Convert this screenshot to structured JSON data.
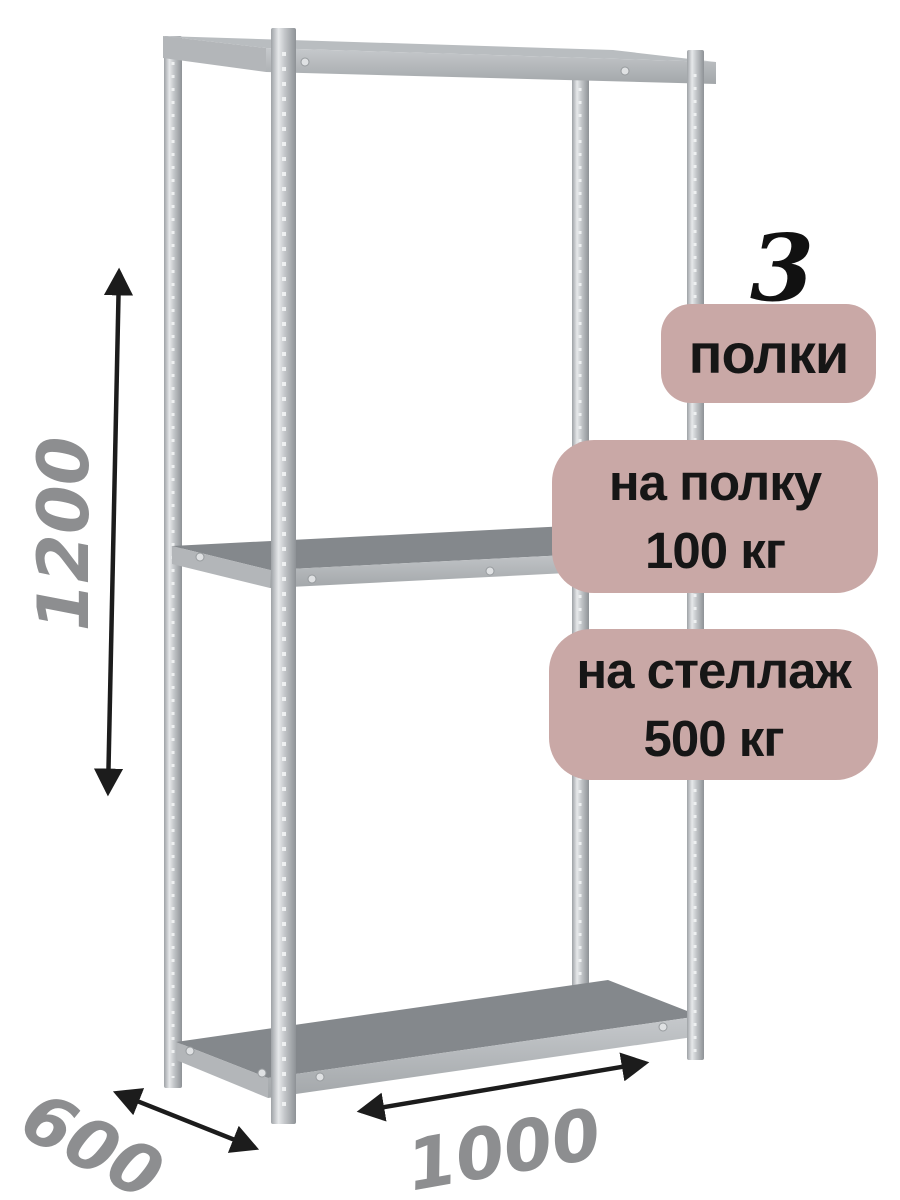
{
  "badges": {
    "shelf_count": {
      "number": "3",
      "label": "полки"
    },
    "shelf_load": {
      "line1": "на полку",
      "line2": "100 кг"
    },
    "rack_load": {
      "line1": "на стеллаж",
      "line2": "500 кг"
    }
  },
  "dimensions": {
    "height": "1200",
    "depth": "600",
    "width": "1000"
  },
  "colors": {
    "background": "#ffffff",
    "badge_bg": "#c9a8a6",
    "badge_text": "#161616",
    "count_text": "#111111",
    "dimension_text": "#8d8e90",
    "arrow": "#1c1c1c",
    "metal_light": "#e8eaec",
    "metal_mid": "#b9bdc0",
    "metal_dark": "#8e9296",
    "shelf_surface": "#84888c",
    "shelf_edge": "#b3b6b9"
  }
}
